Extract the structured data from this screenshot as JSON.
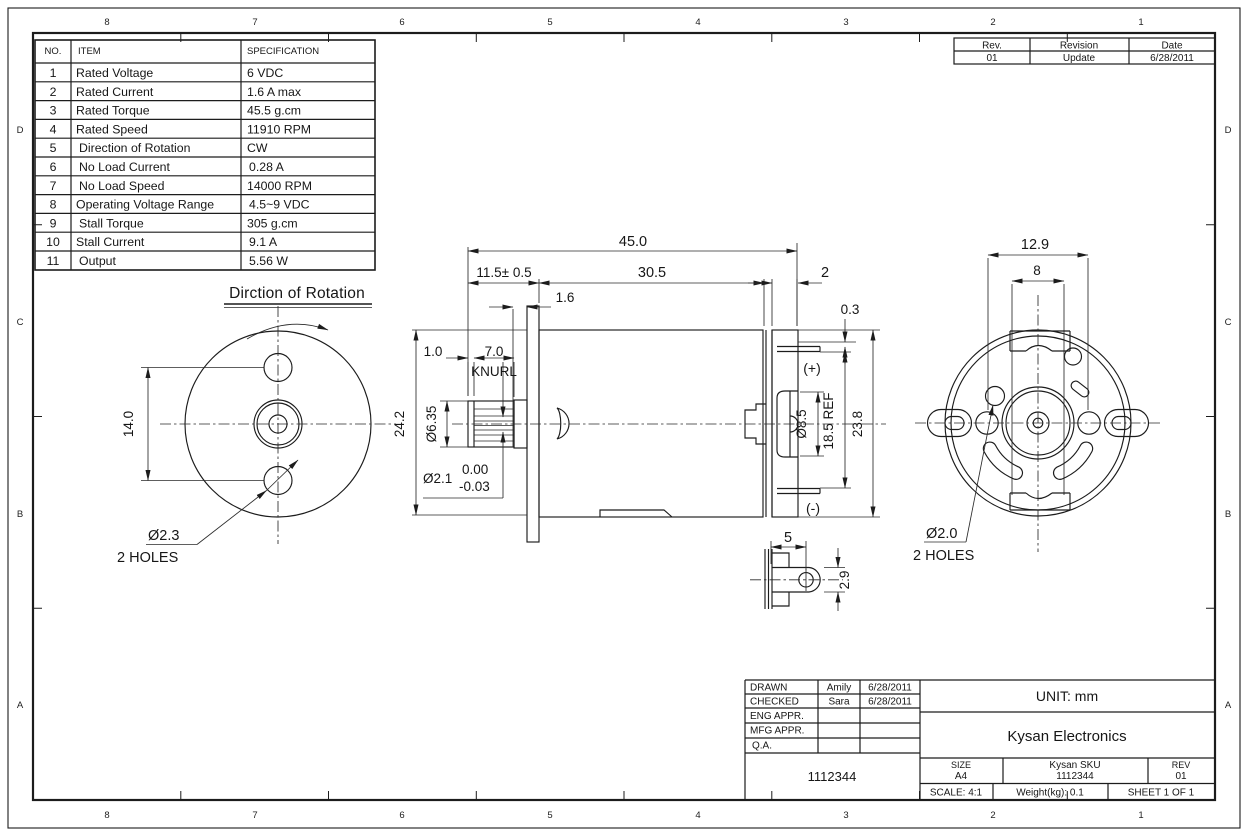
{
  "zones": {
    "top": [
      "8",
      "7",
      "6",
      "5",
      "4",
      "3",
      "2",
      "1"
    ],
    "bottom": [
      "8",
      "7",
      "6",
      "5",
      "4",
      "3",
      "2",
      "1"
    ],
    "left": [
      "D",
      "C",
      "B",
      "A"
    ],
    "right": [
      "D",
      "C",
      "B",
      "A"
    ]
  },
  "spec_table": {
    "headers": {
      "no": "NO.",
      "item": "ITEM",
      "spec": "SPECIFICATION"
    },
    "rows": [
      {
        "no": "1",
        "item": "Rated Voltage",
        "spec": "6 VDC"
      },
      {
        "no": "2",
        "item": "Rated Current",
        "spec": "1.6 A max"
      },
      {
        "no": "3",
        "item": "Rated Torque",
        "spec": "45.5 g.cm"
      },
      {
        "no": "4",
        "item": "Rated Speed",
        "spec": "11910 RPM"
      },
      {
        "no": "5",
        "item": "Direction of Rotation",
        "spec": "CW"
      },
      {
        "no": "6",
        "item": "No Load Current",
        "spec": "0.28 A"
      },
      {
        "no": "7",
        "item": "No Load Speed",
        "spec": "14000 RPM"
      },
      {
        "no": "8",
        "item": "Operating Voltage Range",
        "spec": "4.5~9 VDC"
      },
      {
        "no": "9",
        "item": "Stall Torque",
        "spec": "305 g.cm"
      },
      {
        "no": "10",
        "item": "Stall Current",
        "spec": "9.1 A"
      },
      {
        "no": "11",
        "item": "Output",
        "spec": "5.56 W"
      }
    ]
  },
  "revision_table": {
    "headers": {
      "rev": "Rev.",
      "revision": "Revision",
      "date": "Date"
    },
    "row": {
      "rev": "01",
      "revision": "Update",
      "date": "6/28/2011"
    }
  },
  "front_view": {
    "title": "Dirction of Rotation",
    "dim_hole_spacing": "14.0",
    "callout_dia": "Ø2.3",
    "callout_note": "2 HOLES"
  },
  "side_view": {
    "dim_overall": "45.0",
    "dim_shaft_ext": "11.5± 0.5",
    "dim_body": "30.5",
    "dim_endcap": "2",
    "dim_flange": "1.6",
    "dim_tab": "0.3",
    "dim_tip": "1.0",
    "dim_knurl": "7.0",
    "knurl_label": "KNURL",
    "dim_knurl_dia": "Ø6.35",
    "dim_shaft_dia": "Ø2.1",
    "tol_upper": "0.00",
    "tol_lower": "-0.03",
    "dim_flange_od": "24.2",
    "dim_boss_dia": "Ø8.5",
    "dim_terminal_span": "18.5 REF",
    "dim_body_od": "23.8",
    "terminal_plus": "(+)",
    "terminal_minus": "(-)"
  },
  "terminal_detail": {
    "dim_width": "5",
    "dim_height": "2.9"
  },
  "rear_view": {
    "dim_hole_spacing": "12.9",
    "dim_brush_width": "8",
    "callout_dia": "Ø2.0",
    "callout_note": "2 HOLES"
  },
  "title_block": {
    "approval_rows": [
      {
        "label": "DRAWN",
        "name": "Amily",
        "date": "6/28/2011"
      },
      {
        "label": "CHECKED",
        "name": "Sara",
        "date": "6/28/2011"
      },
      {
        "label": "ENG APPR.",
        "name": "",
        "date": ""
      },
      {
        "label": "MFG APPR.",
        "name": "",
        "date": ""
      },
      {
        "label": "Q.A.",
        "name": "",
        "date": ""
      }
    ],
    "drawing_number": "1112344",
    "unit": "UNIT: mm",
    "company": "Kysan Electronics",
    "size_label": "SIZE",
    "size_value": "A4",
    "sku_label": "Kysan SKU",
    "sku_value": "1112344",
    "rev_label": "REV",
    "rev_value": "01",
    "scale": "SCALE: 4:1",
    "weight": "Weight(kg): 0.1",
    "sheet": "SHEET 1 OF 1"
  }
}
